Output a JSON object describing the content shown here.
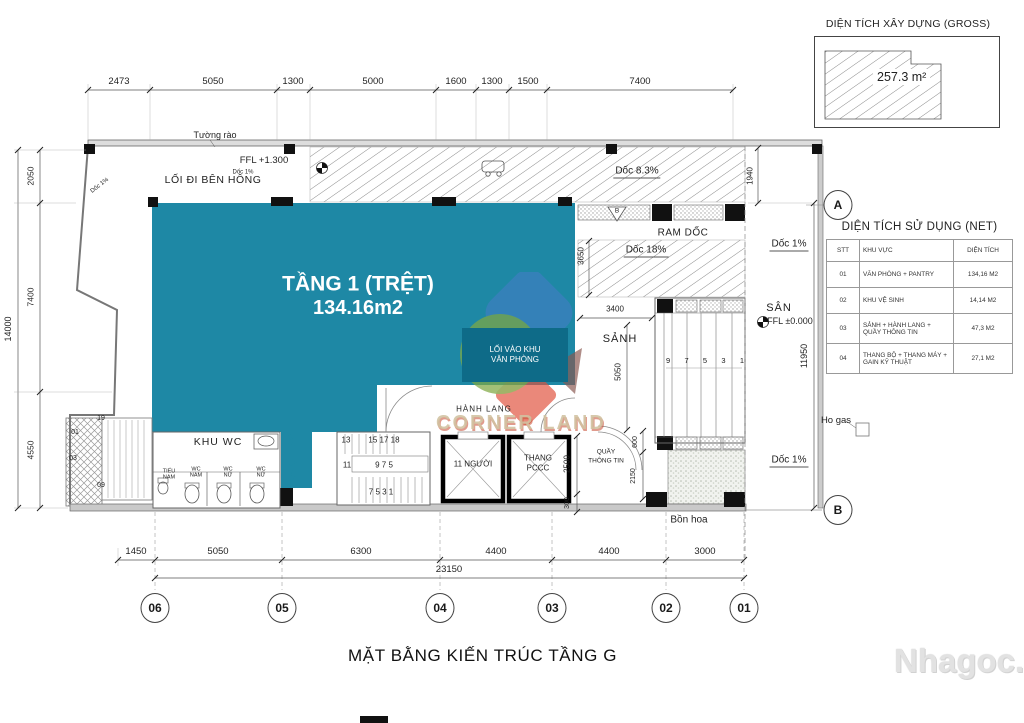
{
  "colors": {
    "teal": "#1E88A5",
    "teal_dark": "#0E6B88"
  },
  "gross": {
    "title": "DIỆN TÍCH XÂY DỰNG (GROSS)",
    "area": "257.3 m²"
  },
  "net": {
    "title": "DIỆN TÍCH SỬ DỤNG (NET)",
    "headers": [
      "STT",
      "KHU VỰC",
      "DIỆN TÍCH"
    ],
    "rows": [
      {
        "stt": "01",
        "area": "VĂN PHÒNG + PANTRY",
        "m2": "134,16 M2"
      },
      {
        "stt": "02",
        "area": "KHU VỆ SINH",
        "m2": "14,14 M2"
      },
      {
        "stt": "03",
        "area": "SẢNH + HÀNH LANG + QUẦY THÔNG TIN",
        "m2": "47,3 M2"
      },
      {
        "stt": "04",
        "area": "THANG BỘ + THANG MÁY + GAIN KỸ THUẬT",
        "m2": "27,1 M2"
      }
    ]
  },
  "plan": {
    "main_room": {
      "line1": "TẦNG 1 (TRỆT)",
      "line2": "134.16m2"
    },
    "entry": {
      "line1": "LỐI VÀO KHU",
      "line2": "VĂN PHÒNG"
    },
    "labels": {
      "tuong_rao": "Tường rào",
      "ffl_1300": "FFL +1.300",
      "loi_di": "LỐI ĐI BÊN HÔNG",
      "doc_83": "Dốc 8.3%",
      "ram_doc": "RAM DỐC",
      "doc_18": "Dốc 18%",
      "doc_1": "Dốc 1%",
      "sanh": "SẢNH",
      "san": "SÂN",
      "ffl_0": "FFL ±0.000",
      "ho_gas": "Ho gas",
      "bon_hoa": "Bồn hoa",
      "hanh_lang": "HÀNH LANG",
      "khu_wc": "KHU WC",
      "pantry": "PANTRY",
      "elevator": "11 NGƯỜI",
      "thang": "THANG",
      "pccc": "PCCC",
      "quay_1": "QUẦY",
      "quay_2": "THÔNG TIN",
      "wc_nam": "WC NAM",
      "wc_nu": "WC NỮ",
      "tieu_nam": "TIỂU NAM",
      "section_b": "B"
    },
    "stairs": {
      "s1": "13",
      "s2": "15 17 18",
      "s3": "11",
      "s4": "9 7 5",
      "s5": "7 5 3 1"
    },
    "parking_left": [
      "19",
      "01",
      "03",
      "09"
    ],
    "parking_right": [
      "9",
      "7",
      "5",
      "3",
      "1"
    ]
  },
  "dims": {
    "top": [
      "2473",
      "5050",
      "1300",
      "5000",
      "1600",
      "1300",
      "1500",
      "7400"
    ],
    "left": [
      "2050",
      "7400",
      "4550"
    ],
    "left_total": "14000",
    "bottom": [
      "1450",
      "5050",
      "6300",
      "4400",
      "4400",
      "3000"
    ],
    "bottom_total": "23150",
    "right_side": "11950",
    "ramp_top": "1940",
    "ramp_mid": "3650",
    "sanh_w": "3400",
    "sanh_h": "5050",
    "elev_h": "2500",
    "elev_b": "300",
    "quay_top": "600",
    "quay_h": "2150"
  },
  "grid": {
    "cols": [
      "06",
      "05",
      "04",
      "03",
      "02",
      "01"
    ],
    "rows": [
      "A",
      "B"
    ]
  },
  "footer": {
    "title": "MẶT BẰNG KIẾN TRÚC TẦNG G"
  },
  "watermarks": {
    "site": "Nhagoc.vn",
    "logo": "CORNER LAND"
  }
}
